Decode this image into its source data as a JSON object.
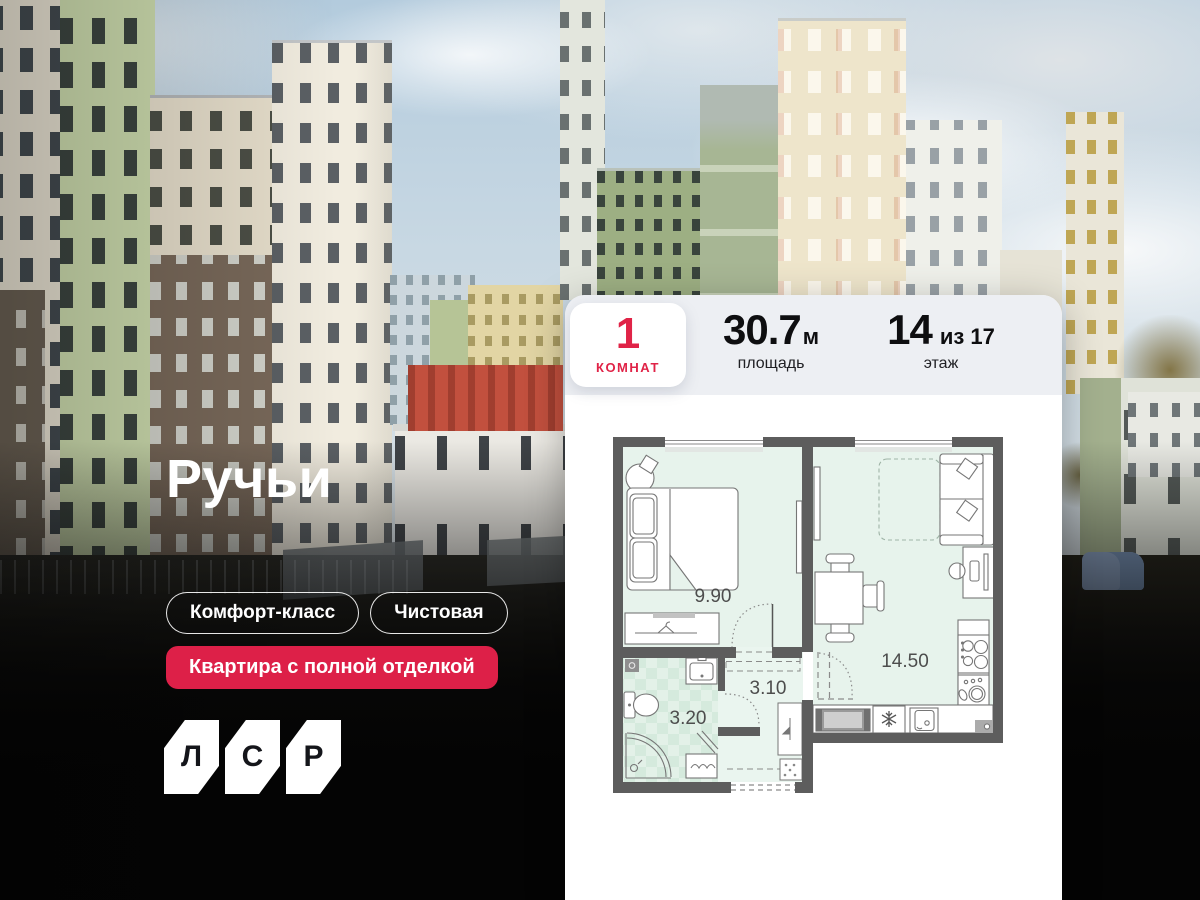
{
  "hero": {
    "title": "Ручьи",
    "tags": [
      {
        "label": "Комфорт-класс"
      },
      {
        "label": "Чистовая"
      }
    ],
    "badge": {
      "label": "Квартира с полной отделкой"
    },
    "logo": {
      "letters": [
        "Л",
        "С",
        "Р"
      ]
    }
  },
  "card": {
    "stats": {
      "rooms": {
        "value": "1",
        "label": "КОМНАТ"
      },
      "area": {
        "value": "30.7",
        "unit": "м",
        "label": "площадь"
      },
      "floor": {
        "value": "14",
        "of": "из 17",
        "label": "этаж"
      }
    },
    "floorplan": {
      "rooms": [
        {
          "name": "bedroom",
          "area": "9.90"
        },
        {
          "name": "living-kitchen",
          "area": "14.50"
        },
        {
          "name": "hallway",
          "area": "3.10"
        },
        {
          "name": "bathroom",
          "area": "3.20"
        }
      ],
      "icons": [
        "bed",
        "armchair",
        "wardrobe-hanger",
        "sofa",
        "dashed-bed",
        "desk",
        "dining-table",
        "stove-burners",
        "dish-sink",
        "fridge-snowflake",
        "washer",
        "bathroom-sink",
        "toilet",
        "shower",
        "laundry-basket",
        "towel",
        "entry-door",
        "coat-hook"
      ]
    }
  },
  "colors": {
    "accent_red": "#dd2048",
    "stats_bg": "#edeff3",
    "card_bg": "#ffffff",
    "plan_wall": "#5d5d5d",
    "plan_floor": "#e7f3ec",
    "plan_floor_alt": "#d5eadd"
  }
}
